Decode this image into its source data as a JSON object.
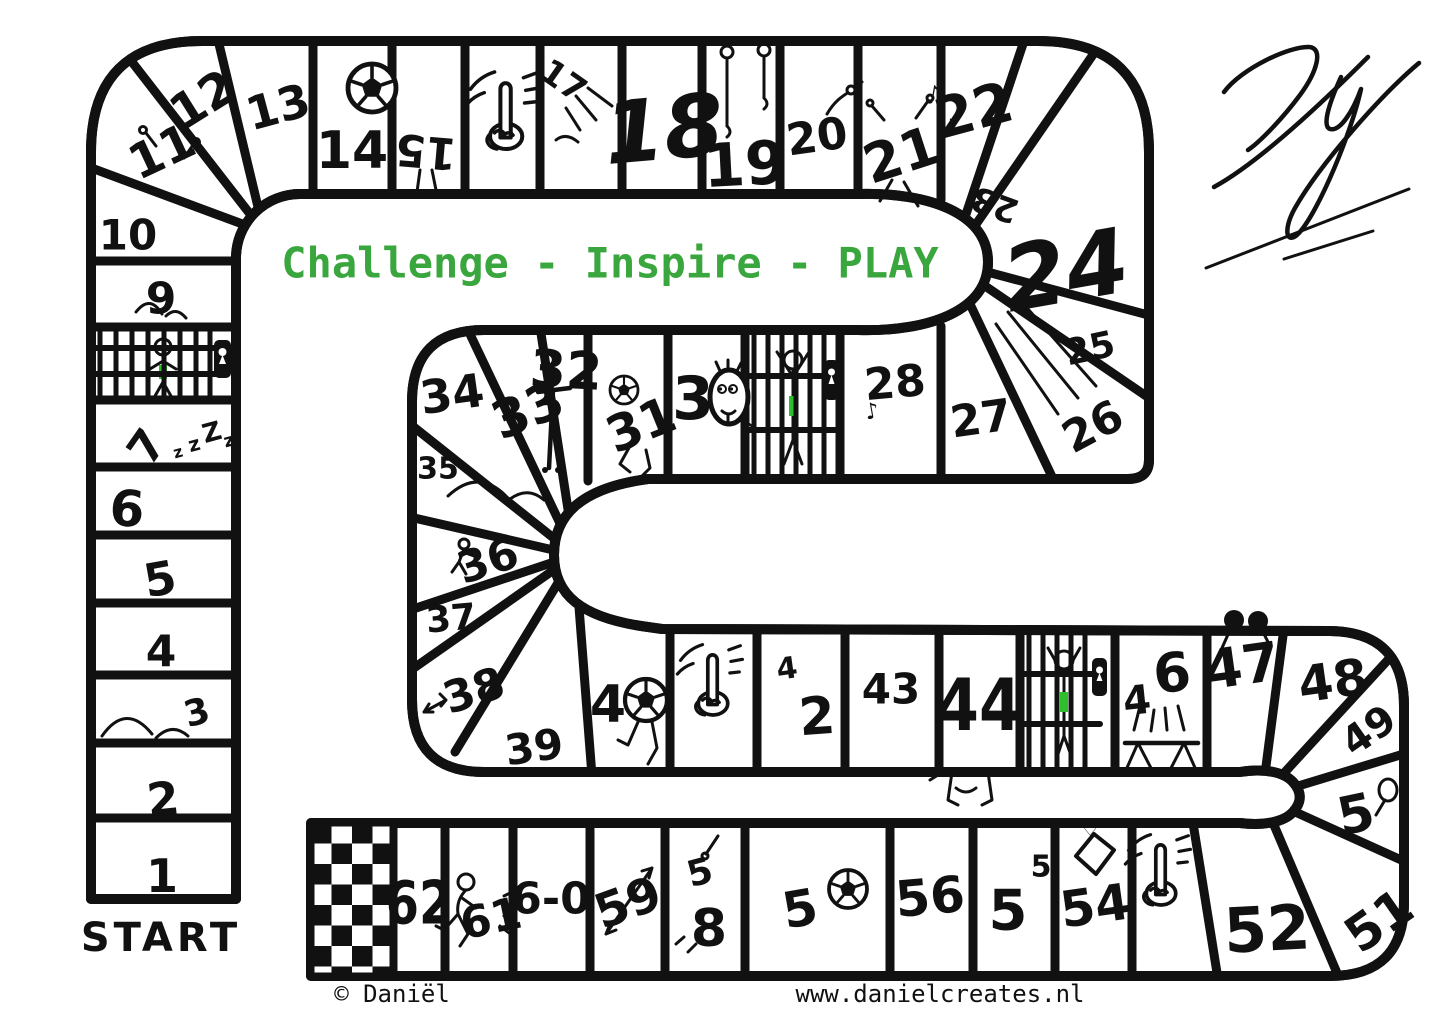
{
  "board": {
    "motto": "Challenge - Inspire - PLAY",
    "start_label": "START",
    "signature": "DY",
    "colors": {
      "ink": "#111111",
      "motto_green": "#3aa63e",
      "lock_green": "#2fbe2f",
      "background": "#ffffff"
    },
    "footer": {
      "copyright": "© Daniël",
      "website": "www.danielcreates.nl"
    },
    "decor": {
      "sleep": [
        "z",
        "z",
        "Z",
        "z"
      ],
      "music_notes": [
        "♪",
        "♪"
      ],
      "music_note_28": "♪",
      "gift_heart": "♡"
    },
    "cells": [
      {
        "num": 1,
        "label": "1"
      },
      {
        "num": 2,
        "label": "2"
      },
      {
        "num": 3,
        "label": "3",
        "icon": "jump-arcs"
      },
      {
        "num": 4,
        "label": "4"
      },
      {
        "num": 5,
        "label": "5"
      },
      {
        "num": 6,
        "label": "6"
      },
      {
        "num": 7,
        "label": "7",
        "icon": "sleep-zzz"
      },
      {
        "num": 8,
        "label": "",
        "icon": "jail"
      },
      {
        "num": 9,
        "label": "9",
        "icon": "jump-arcs"
      },
      {
        "num": 10,
        "label": "10"
      },
      {
        "num": 11,
        "label": "11",
        "icon": "ski-poles-figure"
      },
      {
        "num": 12,
        "label": "12"
      },
      {
        "num": 13,
        "label": "13"
      },
      {
        "num": 14,
        "label": "14",
        "icon": "soccer-ball"
      },
      {
        "num": 15,
        "label": "15",
        "icon": "upside-down-legs"
      },
      {
        "num": 16,
        "label": "",
        "icon": "pointing-finger"
      },
      {
        "num": 17,
        "label": "17",
        "icon": "burst-lines"
      },
      {
        "num": 18,
        "label": "18"
      },
      {
        "num": 19,
        "label": "19",
        "icon": "gym-rings"
      },
      {
        "num": 20,
        "label": "20",
        "icon": "reaching-arm"
      },
      {
        "num": 21,
        "label": "21",
        "icon": "dancing-figure-music-notes"
      },
      {
        "num": 22,
        "label": "22"
      },
      {
        "num": 23,
        "label": "23"
      },
      {
        "num": 24,
        "label": "24"
      },
      {
        "num": 25,
        "label": "25"
      },
      {
        "num": 26,
        "label": "26",
        "icon": "speed-lines"
      },
      {
        "num": 27,
        "label": "27"
      },
      {
        "num": 28,
        "label": "28",
        "icon": "music-note"
      },
      {
        "num": 29,
        "label": "",
        "icon": "jail"
      },
      {
        "num": 30,
        "label": "3",
        "icon": "smiley-face-zero"
      },
      {
        "num": 31,
        "label": "31",
        "icon": "soccer-ball-kick"
      },
      {
        "num": 32,
        "label": "32",
        "icon": "pole"
      },
      {
        "num": 33,
        "label": "33"
      },
      {
        "num": 34,
        "label": "34"
      },
      {
        "num": 35,
        "label": "35",
        "icon": "jump-arcs"
      },
      {
        "num": 36,
        "label": "36",
        "icon": "stick-figure"
      },
      {
        "num": 37,
        "label": "37"
      },
      {
        "num": 38,
        "label": "38",
        "icon": "dart"
      },
      {
        "num": 39,
        "label": "39"
      },
      {
        "num": 40,
        "label": "4",
        "icon": "soccer-ball-zero"
      },
      {
        "num": 41,
        "label": "",
        "icon": "pointing-finger"
      },
      {
        "num": 42,
        "parts": [
          "4",
          "2"
        ]
      },
      {
        "num": 43,
        "label": "43"
      },
      {
        "num": 44,
        "label": "44",
        "icon": "feet"
      },
      {
        "num": 45,
        "label": "",
        "icon": "jail"
      },
      {
        "num": 46,
        "parts": [
          "4",
          "6"
        ],
        "icon": "trampoline"
      },
      {
        "num": 47,
        "label": "47",
        "icon": "binoculars-figure"
      },
      {
        "num": 48,
        "label": "48"
      },
      {
        "num": 49,
        "label": "49"
      },
      {
        "num": 50,
        "label": "5",
        "icon": "balloon-zero"
      },
      {
        "num": 51,
        "label": "51"
      },
      {
        "num": 52,
        "label": "52"
      },
      {
        "num": 53,
        "label": "",
        "icon": "pointing-finger"
      },
      {
        "num": 54,
        "label": "54",
        "icon": "gift-box"
      },
      {
        "num": 55,
        "parts": [
          "5",
          "5"
        ]
      },
      {
        "num": 56,
        "label": "56"
      },
      {
        "num": 57,
        "label": "5",
        "icon": "soccer-ball"
      },
      {
        "num": 58,
        "parts": [
          "5",
          "8"
        ],
        "icon": "reaching-arm"
      },
      {
        "num": 59,
        "label": "59",
        "icon": "arrow"
      },
      {
        "num": 60,
        "label": "6-0"
      },
      {
        "num": 61,
        "label": "61",
        "icon": "running-figure"
      },
      {
        "num": 62,
        "label": "62"
      }
    ],
    "finish": {
      "icon": "checkered-flag"
    }
  }
}
